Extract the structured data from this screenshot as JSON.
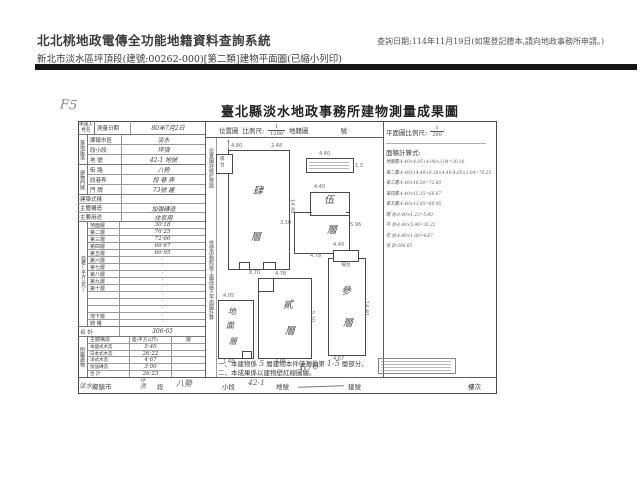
{
  "page": {
    "app_title": "北北桃地政電傳全功能地籍資料查詢系統",
    "subtitle": "新北市淡水區坪頂段(建號:00262-000)[第二類]建物平面圖(已縮小列印)",
    "query_date": "查詢日期:114年11月19日(如需登記謄本,請向地政事務所申請。)"
  },
  "doc": {
    "corner_mark": "F5",
    "title": "臺北縣淡水地政事務所建物測量成果圖",
    "left_table": {
      "applicant_label": "申請人姓名",
      "survey_date_label": "測量日期",
      "survey_date_value": "80年7月2日",
      "site_group": "基地座落",
      "site_rows": [
        {
          "label": "鄉鎮市區",
          "value": "淡水"
        },
        {
          "label": "段小段",
          "value": "坪頂"
        },
        {
          "label": "地 號",
          "value": "42-1 地號"
        }
      ],
      "address_group": "建物門牌",
      "address_rows": [
        {
          "label": "街 路",
          "value": "八勢"
        },
        {
          "label": "段巷弄",
          "value": "段 巷 弄"
        },
        {
          "label": "門 牌",
          "value": "73號 建"
        }
      ],
      "misc_rows": [
        {
          "label": "建築式樣",
          "value": ""
        },
        {
          "label": "主體構造",
          "value": "加強磚造"
        },
        {
          "label": "主要用途",
          "value": "住家用"
        }
      ],
      "floors_group": "面積(平方公尺)",
      "floor_rows": [
        {
          "label": "地面層",
          "value": "30·18"
        },
        {
          "label": "第二層",
          "value": "76·25"
        },
        {
          "label": "第三層",
          "value": "72·60"
        },
        {
          "label": "第四層",
          "value": "66·67"
        },
        {
          "label": "第五層",
          "value": "60·95"
        },
        {
          "label": "第六層",
          "value": "·"
        },
        {
          "label": "第七層",
          "value": "·"
        },
        {
          "label": "第八層",
          "value": "·"
        },
        {
          "label": "第九層",
          "value": "·"
        },
        {
          "label": "第十層",
          "value": "·"
        },
        {
          "label": "",
          "value": "·"
        },
        {
          "label": "",
          "value": "·"
        },
        {
          "label": "",
          "value": "·"
        },
        {
          "label": "地下層",
          "value": "·"
        },
        {
          "label": "騎 樓",
          "value": "·"
        }
      ],
      "total_label": "合 計",
      "total_value": "306·65",
      "attached_group": "附屬建物",
      "attached_header": [
        "主體構造",
        "面(平方公尺)",
        "層"
      ],
      "attached_rows": [
        {
          "label": "本國式木造",
          "value": "5·40",
          "layer": ""
        },
        {
          "label": "日本式木造",
          "value": "26·22",
          "layer": ""
        },
        {
          "label": "洋式木造",
          "value": "4·67",
          "layer": ""
        },
        {
          "label": "加強磚造",
          "value": "3·00",
          "layer": ""
        },
        {
          "label": "合 計",
          "value": "26·23",
          "layer": ""
        }
      ]
    },
    "strips": {
      "s1": "位置圖詳繪於旁面",
      "s2": "依使用執照竣工圖改繪之平面圖計算"
    },
    "map_header": {
      "loc": "位置圖",
      "scale": "比例尺:",
      "num": "1",
      "den": "1200",
      "cad": "地籍圖",
      "no": "號"
    },
    "right_panel": {
      "scale_label": "平面圖比例尺:",
      "num": "1",
      "den": "200",
      "calc_label": "面積計算式:",
      "calc_lines": [
        "地面層:4.40×4.05+4.00×3.04=30.18",
        "第二層:4.40×14.48+0.18×4.40-4.05×3.04=76.25",
        "第三層:4.40×16.50=72.60",
        "第四層:4.40×15.15=66.67",
        "第五層:4.40×13.85=60.95",
        "陽 台:4.40×1.23=5.40",
        "平 台:4.40×5.96=26.22",
        "花 台:4.40×1.06=4.67",
        "合 計:306.65"
      ]
    },
    "plans": {
      "p4": {
        "ch1": "肆",
        "ch2": "層",
        "balcony": "陽台",
        "dim_top": "4.80",
        "dim_tr": "2.48",
        "dim_right": "14.48",
        "dim_bottom": "8.70"
      },
      "annex": {
        "dim_top": "4.40",
        "dim_right": "1.3"
      },
      "p5": {
        "ch1": "伍",
        "ch2": "層",
        "dim_top": "4.40",
        "dim_left": "3.10",
        "dim_right": "5.96",
        "dim_bottom": "4.78"
      },
      "pg": {
        "ch1": "地",
        "ch2": "面",
        "ch3": "層",
        "dim_top": "4.05",
        "dim_bottom": "1.48"
      },
      "p2": {
        "ch1": "貳",
        "ch2": "層",
        "dim_top": "4.78",
        "dim_right": "5.10",
        "dim_bottom": "4.05"
      },
      "p3": {
        "ch1": "參",
        "ch2": "層",
        "notch": "陽台",
        "dim_top": "4.40",
        "dim_right": "14.40",
        "dim_bottom": "4.67"
      }
    },
    "notes": {
      "n1a": "一、本建物係",
      "n1h1": "5",
      "n1b": "層建物本件僅測量第",
      "n1h2": "1-5",
      "n1c": "層部分。",
      "n2": "二、本成果係以建物壁紅線圖繪。"
    },
    "hand_number": "670",
    "footer": {
      "area_hand": "淡水",
      "town": "鄉鎮市",
      "sec_hand": "坪頂",
      "sec": "段",
      "subsec_hand": "八勢",
      "subsec": "小段",
      "lot_hand": "42-1",
      "lot": "地號",
      "bld": "建號",
      "floor": "樓次"
    }
  }
}
